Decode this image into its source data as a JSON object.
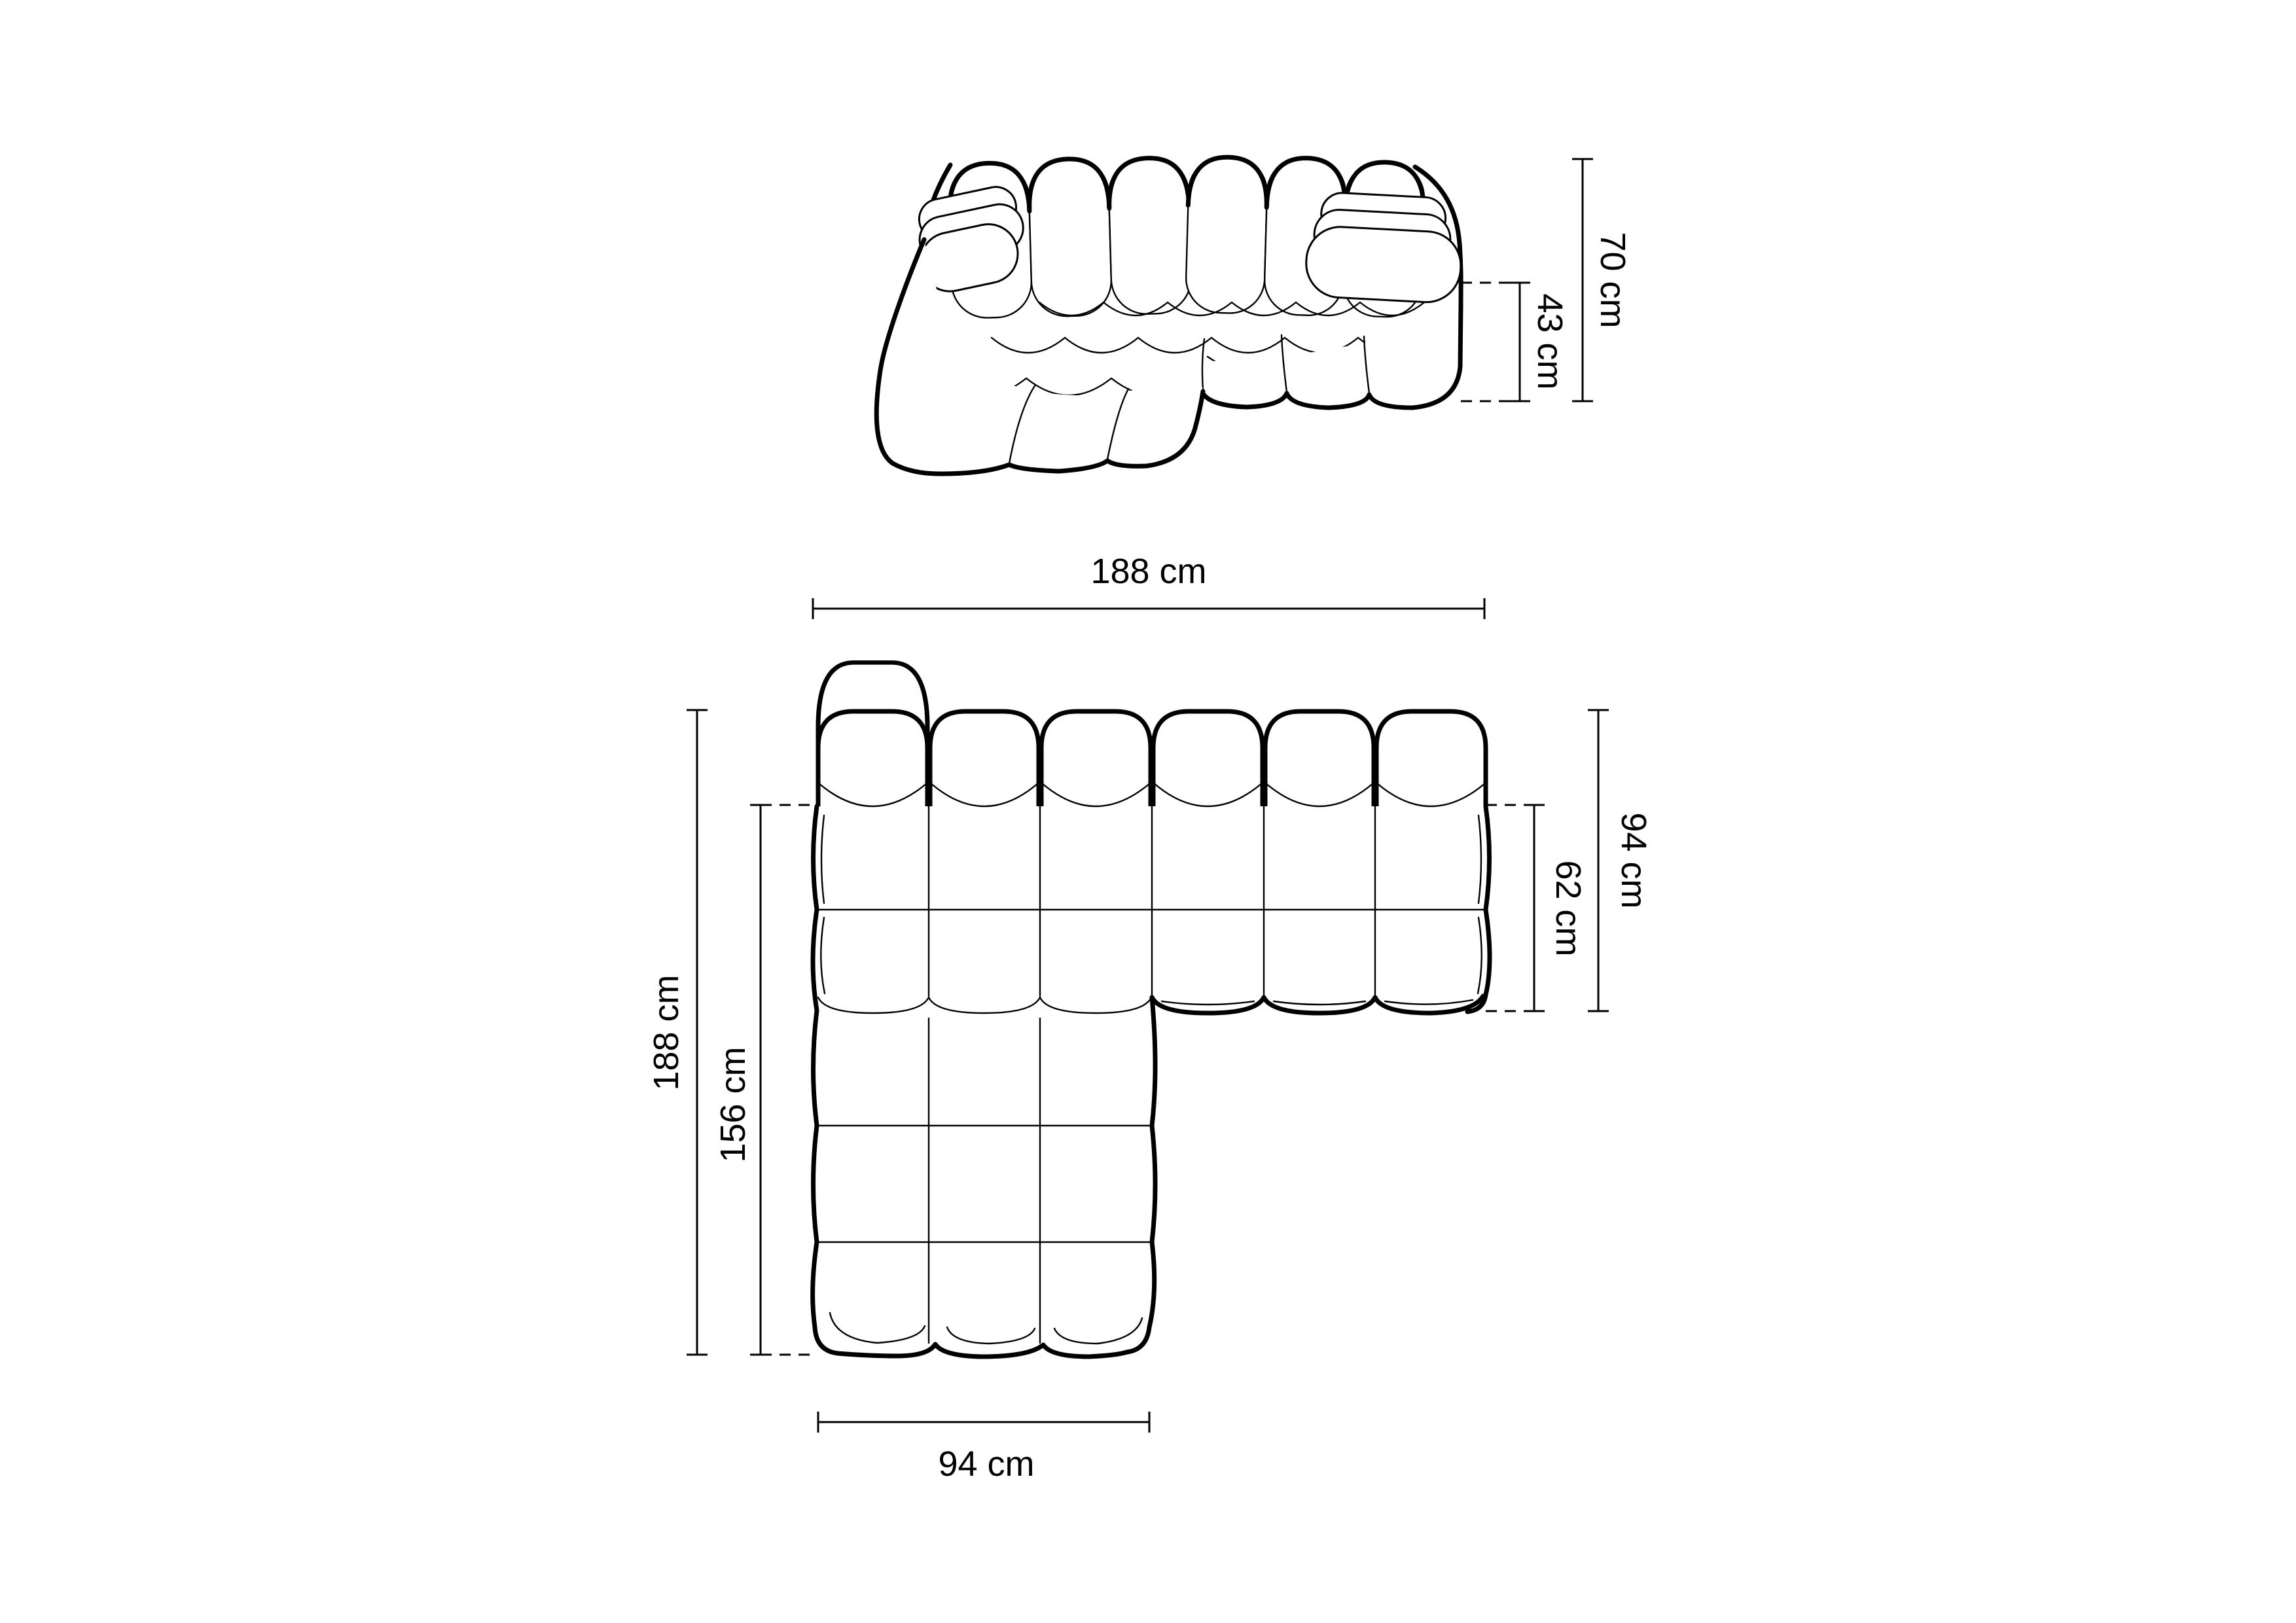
{
  "colors": {
    "background": "#ffffff",
    "line": "#000000",
    "text": "#000000"
  },
  "top_view": {
    "height_total_label": "70 cm",
    "seat_height_label": "43 cm"
  },
  "plan_view": {
    "width_total_label": "188 cm",
    "depth_total_label": "94 cm",
    "seat_depth_label": "62 cm",
    "length_total_label": "188 cm",
    "chaise_length_label": "156 cm",
    "chaise_width_label": "94 cm"
  }
}
